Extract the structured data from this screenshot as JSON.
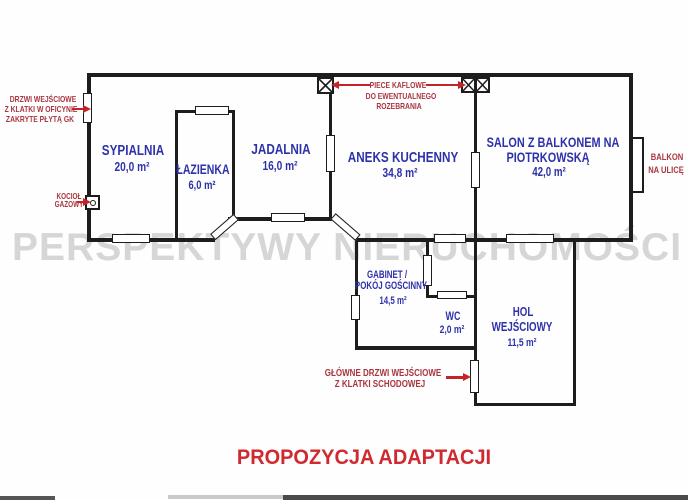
{
  "watermark": "PERSPEKTYWY NIERUCHOMOŚCI",
  "title": "PROPOZYCJA ADAPTACJI",
  "colors": {
    "room_label_blue": "#2e32aa",
    "annotation_red": "#a93540",
    "arrow_red": "#c22428",
    "title_red": "#ce2a30",
    "wall_black": "#1d1d1d",
    "watermark_gray": "#d6d6d6"
  },
  "rooms": {
    "sypialnia": {
      "name": "SYPIALNIA",
      "area": "20,0 m²"
    },
    "lazienka": {
      "name": "ŁAZIENKA",
      "area": "6,0 m²"
    },
    "jadalnia": {
      "name": "JADALNIA",
      "area": "16,0 m²"
    },
    "aneks": {
      "name": "ANEKS KUCHENNY",
      "area": "34,8 m²"
    },
    "salon": {
      "name_line1": "SALON Z BALKONEM NA",
      "name_line2": "PIOTRKOWSKĄ",
      "area": "42,0 m²"
    },
    "gabinet": {
      "name_line1": "GABINET /",
      "name_line2": "POKÓJ GOŚCINNY",
      "area": "14,5 m²"
    },
    "wc": {
      "name": "WC",
      "area": "2,0 m²"
    },
    "hol": {
      "name_line1": "HOL",
      "name_line2": "WEJŚCIOWY",
      "area": "11,5 m²"
    }
  },
  "annotations": {
    "oficyna_door": {
      "line1": "DRZWI WEJŚCIOWE",
      "line2": "Z KLATKI W OFICYNIE",
      "line3": "ZAKRYTE PŁYTĄ GK"
    },
    "boiler": {
      "line1": "KOCIOŁ",
      "line2": "GAZOWY"
    },
    "stoves": {
      "line1": "PIECE KAFLOWE",
      "line2": "DO EWENTUALNEGO",
      "line3": "ROZEBRANIA"
    },
    "balcony": {
      "line1": "BALKON",
      "line2": "NA ULICĘ"
    },
    "main_door": {
      "line1": "GŁÓWNE DRZWI WEJŚCIOWE",
      "line2": "Z KLATKI SCHODOWEJ"
    }
  }
}
